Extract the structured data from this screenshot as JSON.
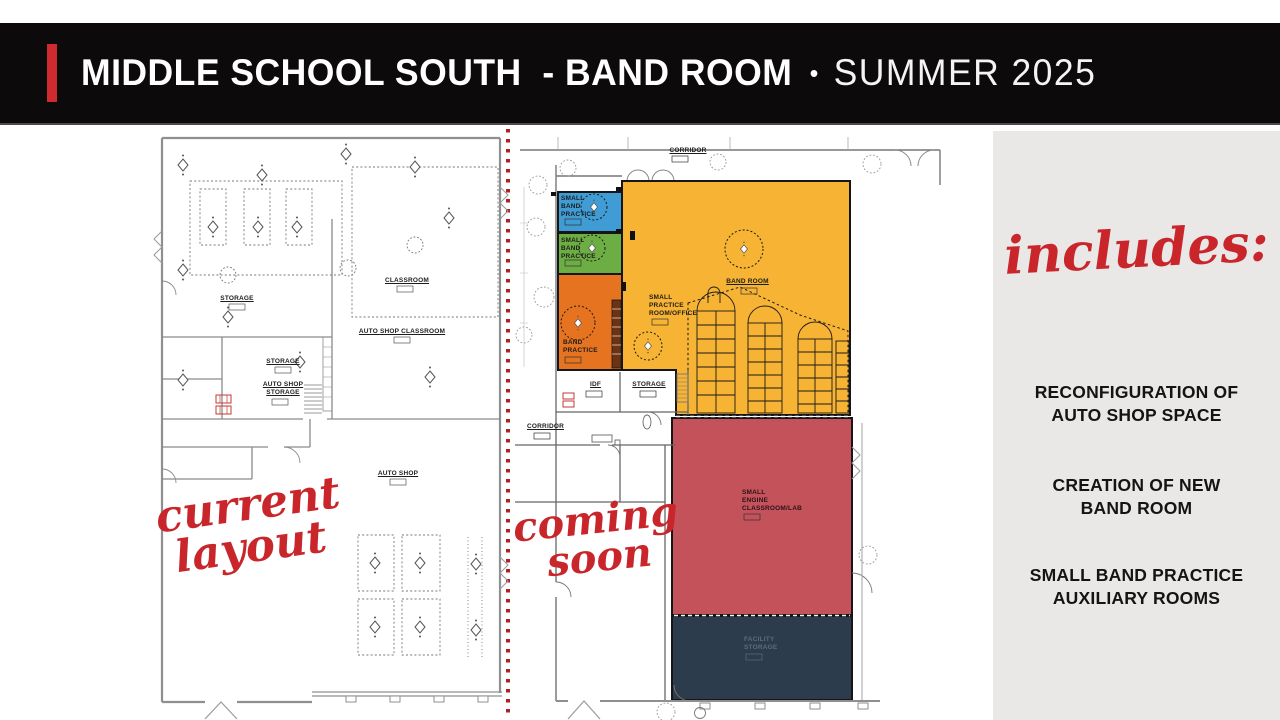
{
  "header": {
    "title": "MIDDLE SCHOOL SOUTH  - BAND ROOM",
    "bullet": "•",
    "season": "SUMMER 2025"
  },
  "left_plan": {
    "annotation": "current\nlayout",
    "labels": {
      "storage_upper": "STORAGE",
      "classroom": "CLASSROOM",
      "auto_shop_classroom": "AUTO SHOP CLASSROOM",
      "storage_mid": "STORAGE",
      "auto_shop_storage": "AUTO SHOP\nSTORAGE",
      "auto_shop": "AUTO SHOP"
    }
  },
  "right_plan": {
    "annotation": "coming\nsoon",
    "labels": {
      "corridor_top": "CORRIDOR",
      "small_band_practice_a": "SMALL\nBAND\nPRACTICE",
      "small_band_practice_b": "SMALL\nBAND\nPRACTICE",
      "band_practice": "BAND\nPRACTICE",
      "band_room": "BAND ROOM",
      "small_practice_office": "SMALL\nPRACTICE\nROOM/OFFICE",
      "idf": "IDF",
      "storage": "STORAGE",
      "corridor_left": "CORRIDOR",
      "small_engine_classroom": "SMALL\nENGINE\nCLASSROOM/LAB",
      "facility_storage": "FACILITY\nSTORAGE"
    }
  },
  "sidebar": {
    "heading": "includes:",
    "items": [
      "RECONFIGURATION OF\nAUTO SHOP SPACE",
      "CREATION OF NEW\nBAND ROOM",
      "SMALL BAND PRACTICE\nAUXILIARY ROOMS"
    ]
  },
  "legend_colors": {
    "band_room_yellow": "#F6B334",
    "small_band_practice_blue": "#3F9CD4",
    "small_band_practice_green": "#6CAE43",
    "band_practice_orange": "#E5731F",
    "small_engine_classroom_red": "#C4525B",
    "facility_storage_navy": "#2D3C4D",
    "accent_red": "#CE2A30",
    "script_red": "#C9262C",
    "panel_gray": "#E9E8E7",
    "header_black": "#0D0A0B"
  }
}
